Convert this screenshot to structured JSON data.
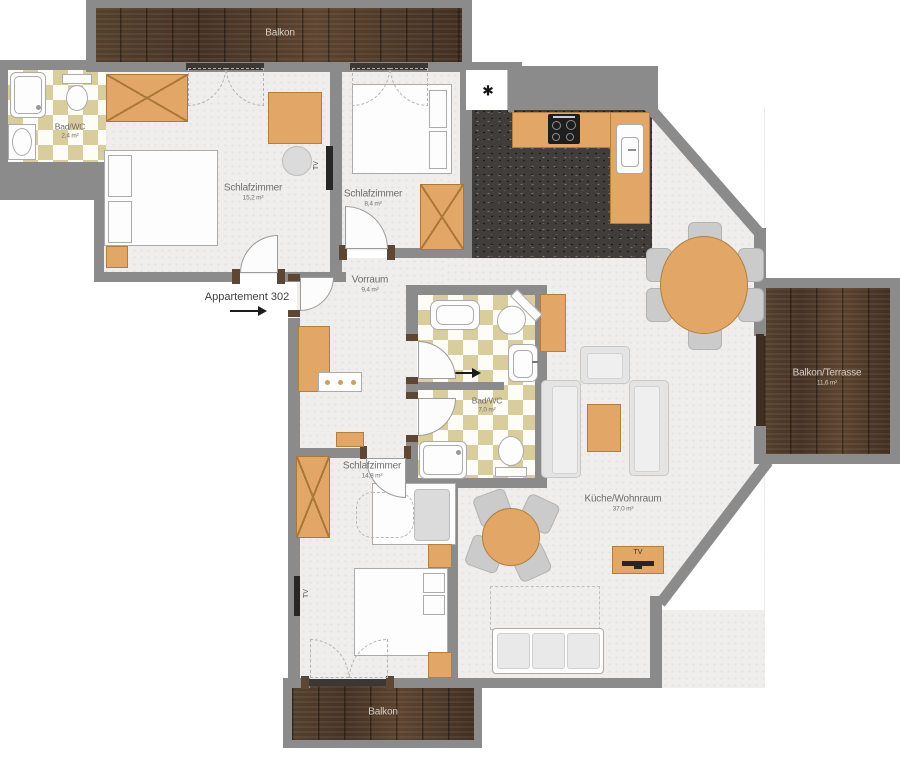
{
  "entrance": {
    "label": "Appartement 302"
  },
  "rooms": {
    "balcony_top": {
      "name": "Balkon"
    },
    "bath_small": {
      "name": "Bad/WC",
      "area": "2,4 m²"
    },
    "bedroom_1": {
      "name": "Schlafzimmer",
      "area": "15,2 m²"
    },
    "bedroom_2": {
      "name": "Schlafzimmer",
      "area": "8,4 m²"
    },
    "hall": {
      "name": "Vorraum",
      "area": "9,4 m²"
    },
    "bath_main": {
      "name": "Bad/WC",
      "area": "7,0 m²"
    },
    "bedroom_3": {
      "name": "Schlafzimmer",
      "area": "14,8 m²"
    },
    "living_kitchen": {
      "name": "Küche/Wohnraum",
      "area": "37,0 m²"
    },
    "terrace": {
      "name": "Balkon/Terrasse",
      "area": "11,6 m²"
    },
    "balcony_bottom": {
      "name": "Balkon"
    }
  },
  "markers": {
    "tv": "TV",
    "storage": "✱"
  },
  "colors": {
    "wall": "#8b8b8b",
    "furniture": "#e2a766",
    "balcony_wood": "#4e3828",
    "tile": "#d9cd9e",
    "kitchen_floor": "#403d3a"
  }
}
